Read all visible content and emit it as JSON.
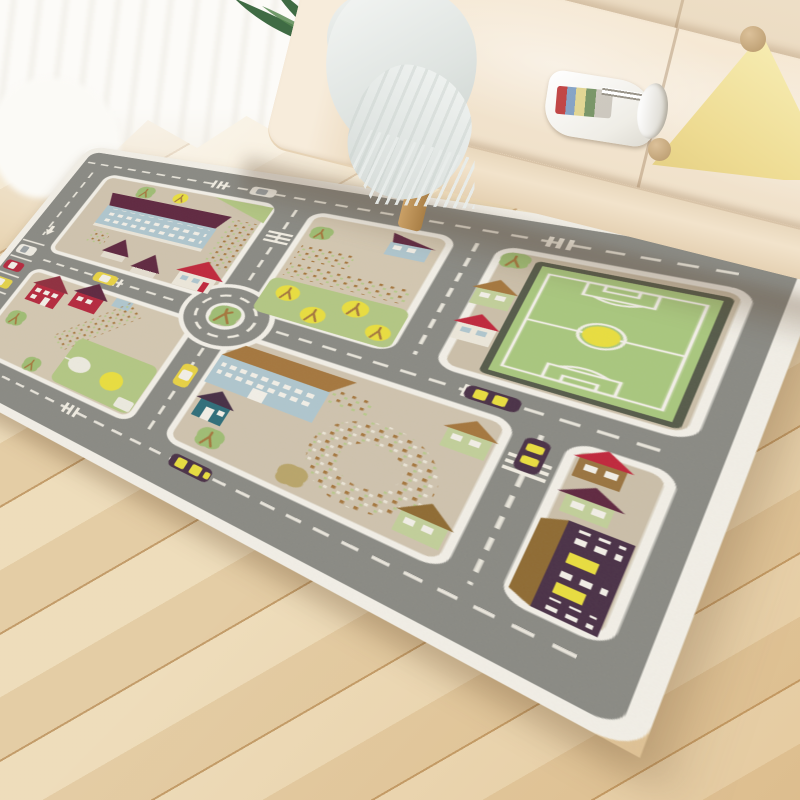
{
  "scene": {
    "description": "Bright living room corner: a children's city-roadmap play rug lies diagonally on a light wood plank floor in front of a cream fabric sofa",
    "objects": {
      "floor": {
        "label": "light wood plank floor",
        "color": "#ecd8b2",
        "plank_gap_color": "#a87636"
      },
      "curtain": {
        "label": "sheer white curtain",
        "color": "#fcfbf8"
      },
      "plant": {
        "label": "palm plant",
        "leaf_color": "#3f6b44"
      },
      "basket": {
        "label": "wicker plant basket",
        "color": "#c1955a"
      },
      "sofa": {
        "label": "cream fabric sofa",
        "color": "#f4e7d2",
        "shadow_color": "#dfc9ac"
      },
      "blanket": {
        "label": "light grey fringed throw blanket",
        "color": "#e3e7e5"
      },
      "magazine": {
        "label": "open magazine on sofa seat",
        "color": "#ffffff"
      },
      "pillow": {
        "label": "pale yellow triangle pillow with pompoms",
        "color": "#f4e6a3",
        "pompom_color": "#c6a97e"
      },
      "rug": {
        "label": "city traffic play rug",
        "border_color": "#f2efe7",
        "road_color": "#8a8a84",
        "block_color": "#cfc3ae",
        "marking_color": "#f0ece1",
        "features": [
          "white rounded border",
          "grey roads with white dashed lines",
          "central roundabout with tree island",
          "parking lot with three parked cars",
          "soccer field with yellow ball",
          "apartment building with maroon roof",
          "red-roof houses",
          "blue school building with brown roof",
          "teal cottage",
          "dotted orchard fields",
          "circular dotted plaza",
          "long dark station building with yellow doors",
          "lawn with four yellow trees",
          "crosswalks",
          "yellow cars",
          "dark cars with yellow windows"
        ],
        "vehicle_colors": {
          "yellow_car": "#e8d244",
          "dark_car": "#4a3147",
          "red_car": "#b5293e",
          "white_car": "#edeae1"
        },
        "building_colors": {
          "maroon_roof": "#5f2840",
          "red_roof": "#c0273c",
          "brown_roof": "#a5773e",
          "blue_facade": "#afc6ce",
          "teal_house": "#2f6e7a",
          "dark_building": "#4a3147",
          "pale_green_wall": "#c2cf9a"
        },
        "greens": {
          "field": "#a9c77e",
          "lawn": "#b3c784",
          "tree": "#9fbd74",
          "yellow_tree": "#e9de3f"
        }
      }
    }
  }
}
